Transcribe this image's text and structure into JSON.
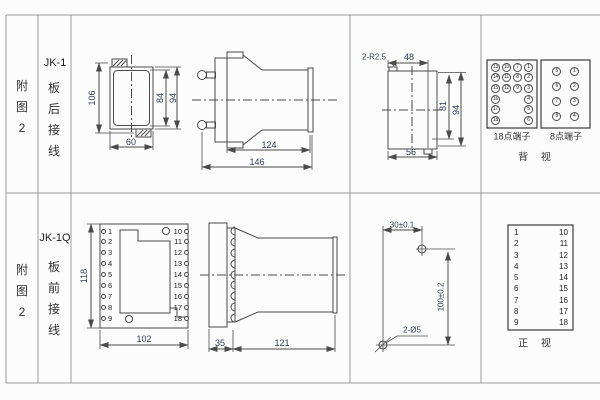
{
  "row1": {
    "figure": "附图2",
    "model": "JK-1",
    "wiring": "板后接线"
  },
  "row2": {
    "figure": "附图2",
    "model": "JK-1Q",
    "wiring": "板前接线"
  },
  "jk1_front": {
    "total_height": "106",
    "case_height": "84",
    "flange_height": "94",
    "width": "60"
  },
  "jk1_side": {
    "case_length": "124",
    "total_length": "146"
  },
  "cutout": {
    "corner_radius": "2-R2.5",
    "top_width": "48",
    "inner_height": "81",
    "height": "94",
    "width": "56"
  },
  "jk1q_front": {
    "height": "118",
    "width": "102"
  },
  "jk1q_side": {
    "flange_depth": "35",
    "case_length": "121"
  },
  "drill": {
    "h_spacing": "30±0.1",
    "v_spacing": "100±0.2",
    "hole_spec": "2-Ø5"
  },
  "terminal_views": {
    "back18_label": "18点端子",
    "back18_grid": [
      [
        "13",
        "10",
        "7",
        "1"
      ],
      [
        "14",
        "11",
        "8",
        "2"
      ],
      [
        "15",
        "12",
        "9",
        "3"
      ],
      [
        "16",
        "",
        "",
        "4"
      ],
      [
        "17",
        "",
        "",
        "5"
      ],
      [
        "18",
        "",
        "",
        "6"
      ]
    ],
    "back8_label": "8点端子",
    "back8_grid": [
      [
        "5",
        "1"
      ],
      [
        "6",
        "2"
      ],
      [
        "7",
        "3"
      ],
      [
        "8",
        "4"
      ]
    ],
    "back_view_label": "背 视",
    "front_left": [
      "1",
      "2",
      "3",
      "4",
      "5",
      "6",
      "7",
      "8",
      "9"
    ],
    "front_right": [
      "10",
      "11",
      "12",
      "13",
      "14",
      "15",
      "16",
      "17",
      "18"
    ],
    "front_view_label": "正 视"
  },
  "colors": {
    "line": "#4a4a4a",
    "grid_line": "#9b9b9b",
    "dim_text": "#303c55",
    "text": "#333333"
  }
}
